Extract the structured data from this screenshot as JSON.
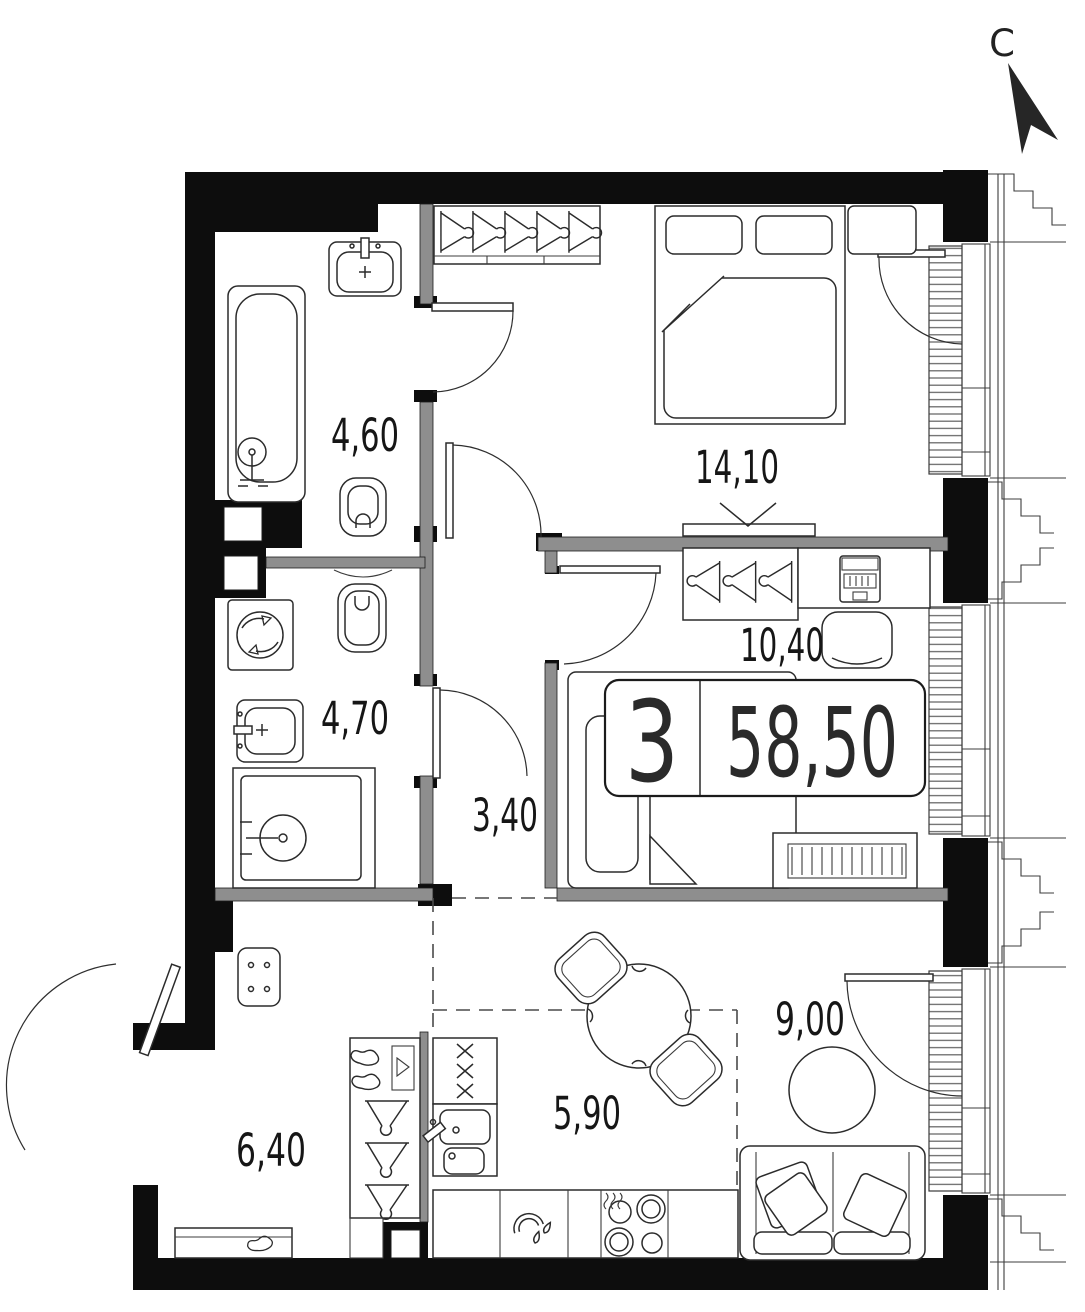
{
  "compass": {
    "north_label": "С"
  },
  "badge": {
    "rooms_count": "3",
    "total_area": "58,50"
  },
  "areas": {
    "bathroom_top": "4,60",
    "bedroom": "14,10",
    "kids_room": "10,40",
    "bathroom_bottom": "4,70",
    "corridor": "3,40",
    "hallway": "6,40",
    "kitchen": "5,90",
    "living": "9,00"
  },
  "colors": {
    "wall": "#0d0d0d",
    "partition": "#8e8e8e",
    "line": "#2b2b2b",
    "background": "#ffffff"
  }
}
